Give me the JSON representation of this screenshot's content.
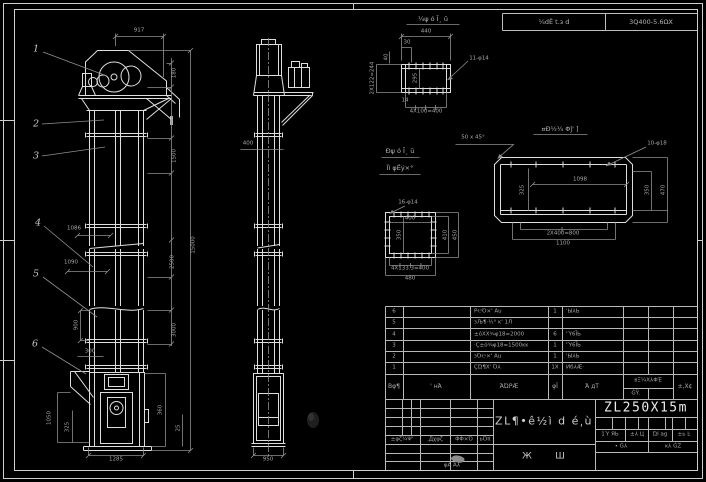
{
  "top_bar": {
    "left": "¼dЁ t.з d",
    "right": "3Q400-5.6ΩΧ"
  },
  "front_view": {
    "balloons": [
      "1",
      "2",
      "3",
      "4",
      "5",
      "6"
    ],
    "dims": {
      "d917": "917",
      "d180": "180",
      "d1500": "1500",
      "d2500": "2500",
      "d3000": "3000",
      "d15000": "15000",
      "d1086": "1086",
      "d1090": "1090",
      "d900": "900",
      "d300": "300",
      "d1050": "1050",
      "d325": "325",
      "d1285": "1285",
      "d360": "360",
      "d25": "25"
    }
  },
  "side_view": {
    "dims": {
      "d400": "400",
      "d950": "950"
    }
  },
  "detail_a": {
    "title": "¼ψ ó Ī¸ ŭ",
    "dims": {
      "d440": "440",
      "d30": "30",
      "d40": "40",
      "d244": "2X122=244",
      "d295": "295",
      "holes": "11-φ14",
      "d400": "4X100=400",
      "d14": "14"
    }
  },
  "detail_b": {
    "title1": "Ðψ ó Ī¸ ŭ",
    "title2": "Ïì φЁý×°",
    "dims": {
      "holes": "16-φ14",
      "d400": "400",
      "d350": "350",
      "d410": "410",
      "d450": "450",
      "d4133": "4X133.3=400",
      "d480": "480"
    }
  },
  "detail_c": {
    "title": "¤Đ½¼ Φĵ' ]",
    "chamfer": "50 x 45°",
    "dims": {
      "holes": "10-φ18",
      "d1098": "1098",
      "d325": "325",
      "d350": "350",
      "d470": "470",
      "d800": "2X400=800",
      "d1100": "1100"
    }
  },
  "bom": {
    "header": {
      "no": "Βφ¶",
      "code": "' нΆ",
      "name": "ΆΏΡÆ",
      "qty": "φΪ",
      "mat": "Ά дΤ",
      "weight": "вΞ¼Χ⅄ΦΈ",
      "weight_sub": "ĠΫ.",
      "note": "±,Χ¢"
    },
    "rows": [
      {
        "no": "6",
        "name": "Ρ℮Ό×' Au",
        "qty": "1",
        "mat": "'Ы⅄Ь"
      },
      {
        "no": "5",
        "name": "зЉ¶·½° ĸ' 1Л",
        "qty": "",
        "mat": ""
      },
      {
        "no": "4",
        "name": "±όΧΧ¾φ18=2000",
        "qty": "6",
        "mat": "'Ύ6ĪЬ"
      },
      {
        "no": "3",
        "name": "·Ç±ό¾φ18=1500ĸĸ",
        "qty": "1",
        "mat": "'Ύ6ĪЬ"
      },
      {
        "no": "2",
        "name": "зΌ℮×' Au",
        "qty": "1",
        "mat": "'Ы⅄Ь"
      },
      {
        "no": "1",
        "name": "ÇΏ¶X' Ό⅄",
        "qty": "1X",
        "mat": "Ͷб⅄Æ·"
      }
    ]
  },
  "title_block": {
    "title": "ZL¶•ê½ì d é͵ù",
    "subtitle_l": "Ж",
    "subtitle_r": "Ш",
    "model": "ZL250X15m",
    "rev_header": [
      "±φζ¼Ψ'",
      "͵Дχφζ",
      "ΦΦ×Ό",
      "ьΌπ"
    ],
    "rev_footer": "φĀ Ά⅄",
    "labels": [
      "1Ύ ЯЬ",
      "±⅄ Ц",
      "ΏΙ ag",
      "±ь Ŀ"
    ],
    "sheet_l": "• Ġ⅄",
    "sheet_r": "ĸ⅄ ĠΖ"
  }
}
